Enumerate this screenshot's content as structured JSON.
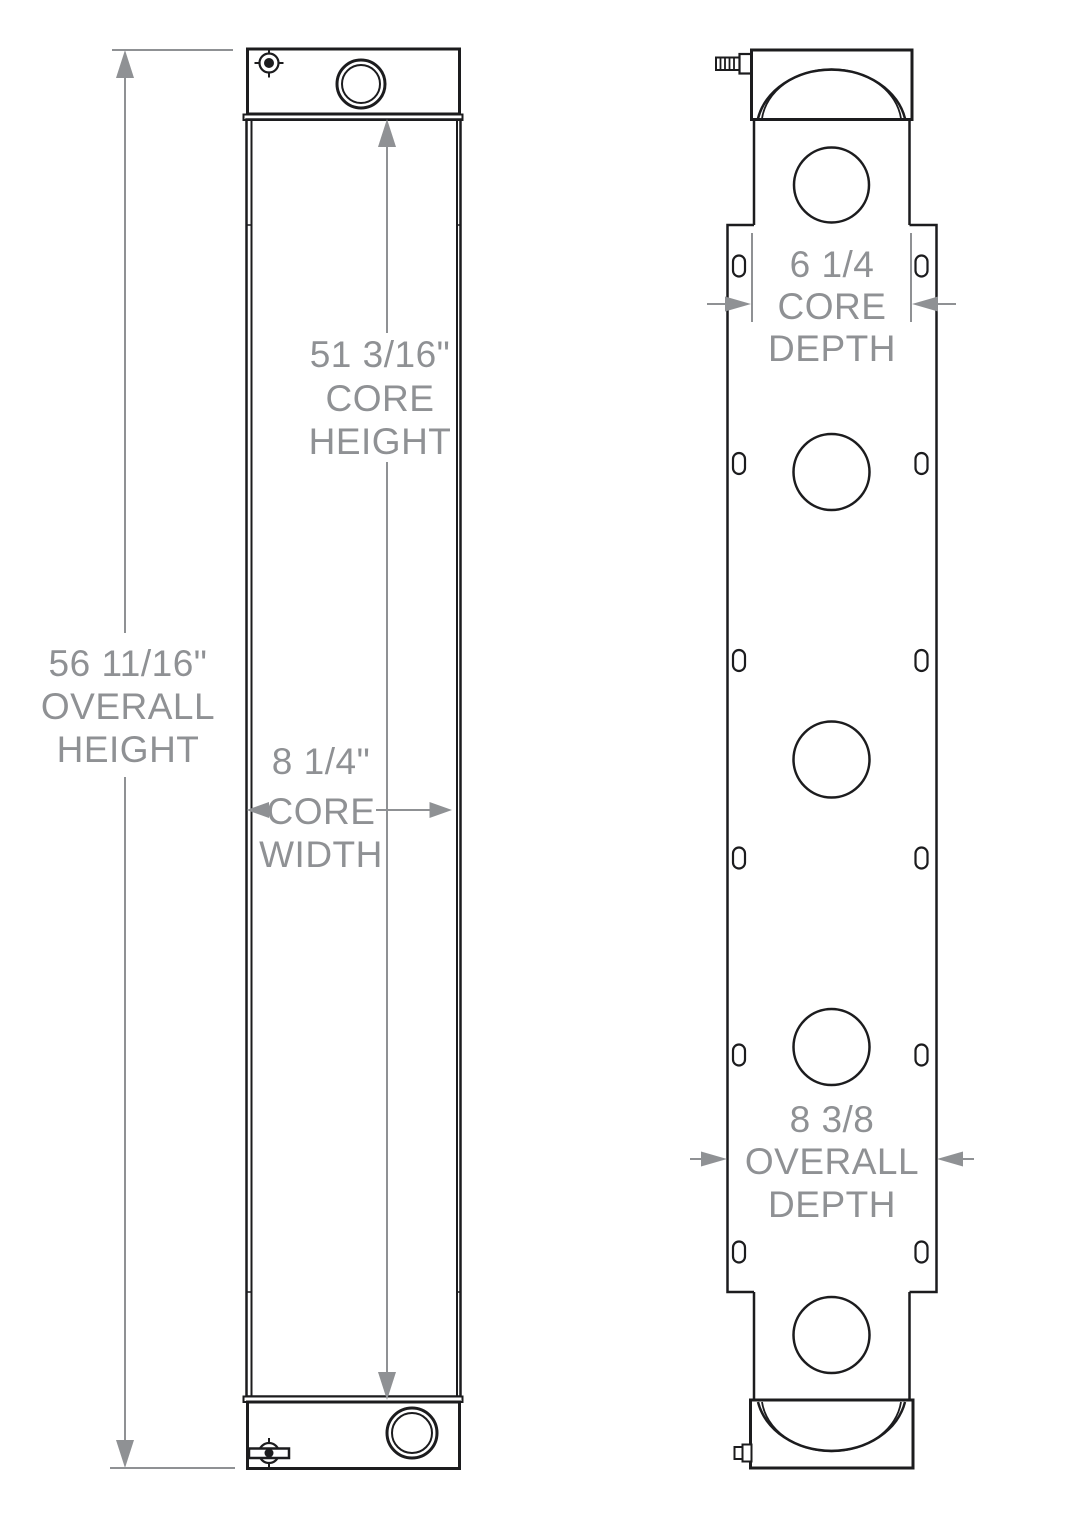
{
  "drawing": {
    "type": "radiator-dimensional-drawing",
    "views": {
      "front": "front-view",
      "side": "side-view"
    }
  },
  "colors": {
    "line": "#1c1c1e",
    "dimension": "#8f9194",
    "background": "#ffffff"
  },
  "dimensions": {
    "overall_height": {
      "lines": [
        "56 11/16\"",
        "OVERALL",
        "HEIGHT"
      ]
    },
    "core_height": {
      "lines": [
        "51 3/16\"",
        "CORE",
        "HEIGHT"
      ]
    },
    "core_width": {
      "lines": [
        "8 1/4\"",
        "CORE",
        "WIDTH"
      ]
    },
    "core_depth": {
      "lines": [
        "6 1/4",
        "CORE",
        "DEPTH"
      ]
    },
    "overall_depth": {
      "lines": [
        "8 3/8",
        "OVERALL",
        "DEPTH"
      ]
    }
  }
}
